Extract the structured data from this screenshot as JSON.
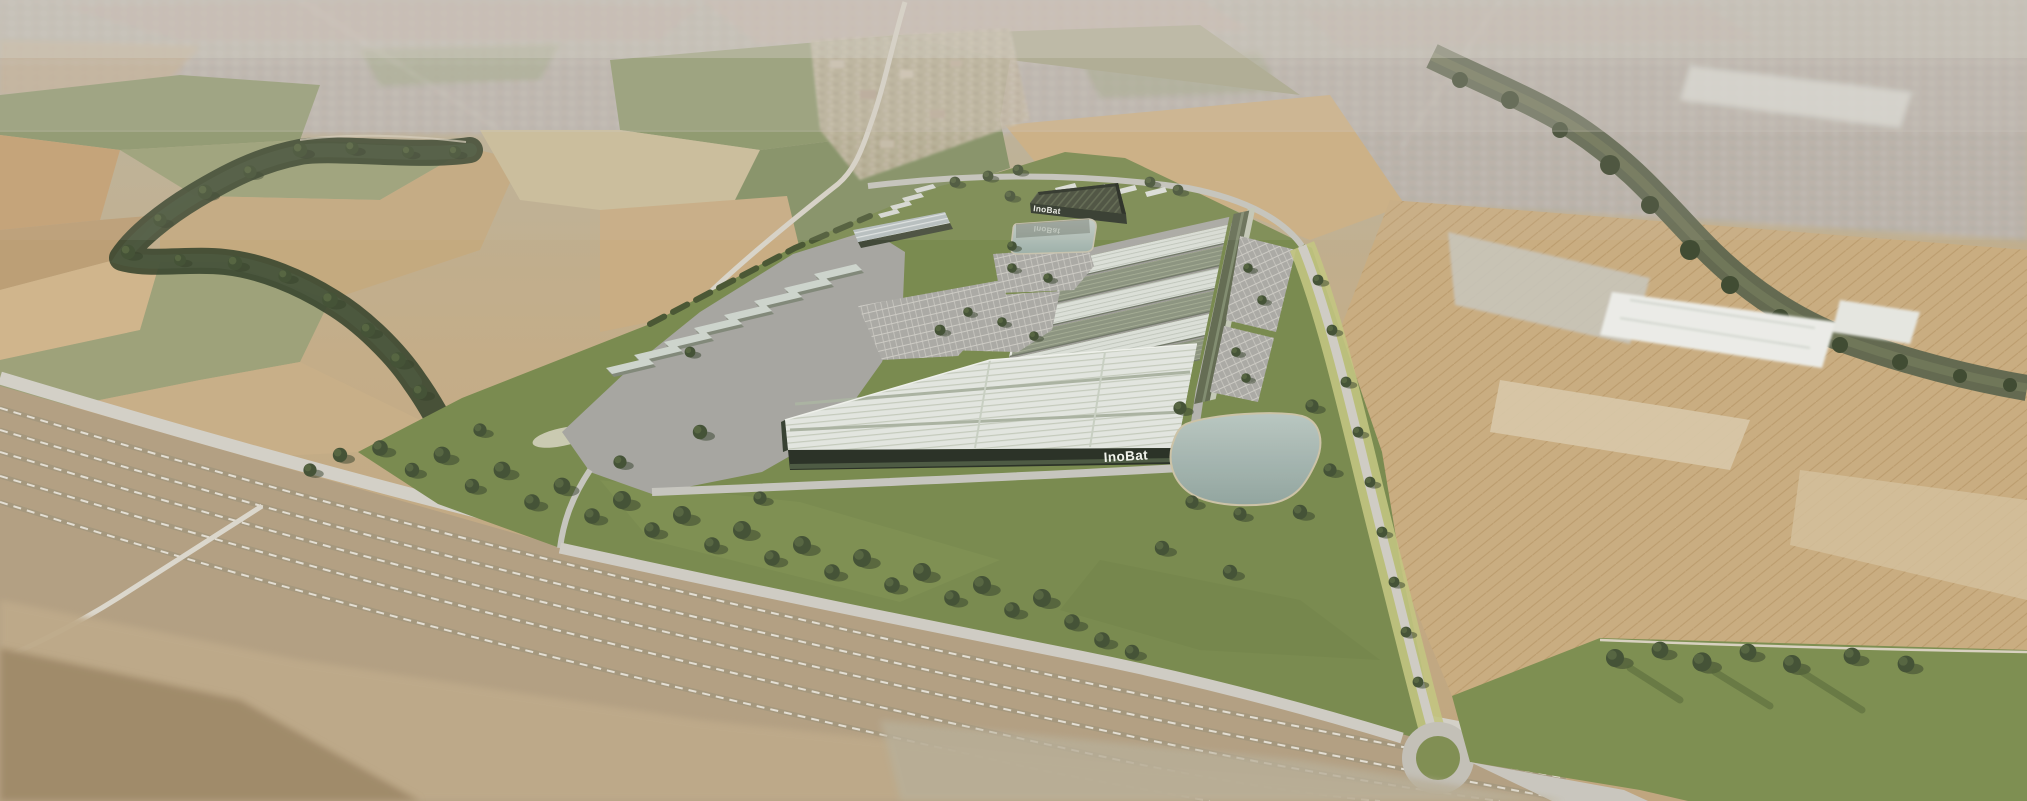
{
  "branding": {
    "hq_logo": "InoBat",
    "hq_logo_reflection": "InoBat",
    "south_facade_logo": "InoBat"
  },
  "palette": {
    "grass": "#75874a",
    "paving": "#a5a4a0",
    "facade": "#232b20",
    "logo-text": "#f3f5ef",
    "field-tan": "#c9ab7e",
    "roof-light": "#dde1da",
    "roof-olive": "#8a927e",
    "pond": "#a9bcb6",
    "river": "#596149",
    "tree": "#3c4a30",
    "ballast": "#b29e80",
    "city-haze": "#b4afa8"
  }
}
